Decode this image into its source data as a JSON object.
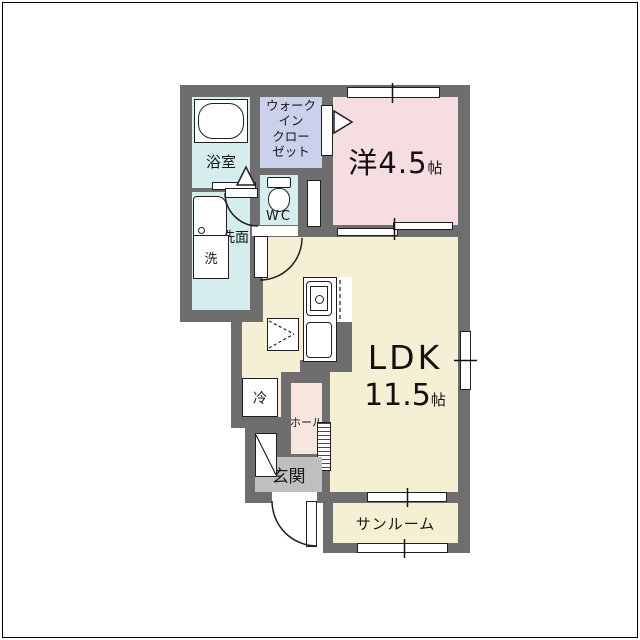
{
  "plan": {
    "type": "floor-plan",
    "rooms": {
      "bathroom": {
        "label": "浴室"
      },
      "walk_in_closet": {
        "label": "ウォーク\nイン\nクロー\nゼット"
      },
      "western_room": {
        "label": "洋4.5",
        "unit": "帖"
      },
      "wc": {
        "label": "WC"
      },
      "washroom": {
        "label": "洗面"
      },
      "ldk": {
        "label": "LDK",
        "size": "11.5",
        "unit": "帖"
      },
      "hall": {
        "label": "ホール"
      },
      "entrance": {
        "label": "玄関"
      },
      "sunroom": {
        "label": "サンルーム"
      }
    },
    "fixtures": {
      "washer": {
        "label": "洗"
      },
      "fridge": {
        "label": "冷"
      }
    },
    "colors": {
      "wall": "#6e6e6e",
      "wet": "#d4eeee",
      "closet": "#cbd1eb",
      "bedroom": "#f5dde2",
      "ldk": "#f5f0d4",
      "hall": "#f7e6dd",
      "entrance": "#c0bfbf"
    }
  }
}
